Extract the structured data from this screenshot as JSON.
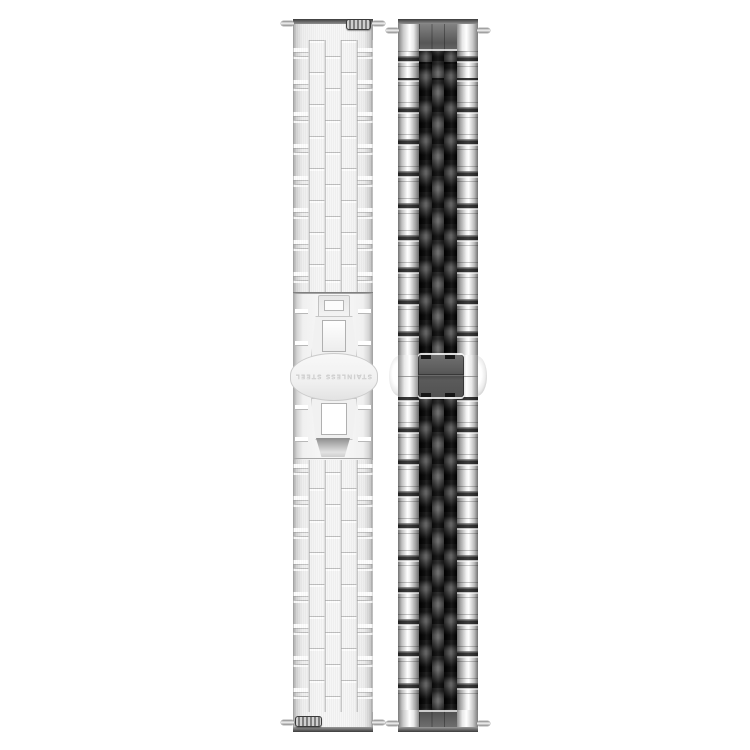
{
  "photo": {
    "background_color": "#ffffff",
    "clasp": {
      "engraving": "STAINLESS STEEL"
    },
    "left_band": {
      "label": "brushed silver link band, back side with folded butterfly clasp",
      "base_color": "#f2f2f2",
      "brick_line_color": "#bdbdbd",
      "edge_shade_color": "#9e9e9e",
      "spring_bar_color": "#3c3c3c"
    },
    "right_band": {
      "label": "five-link band front side, silver outer links with black center links",
      "outer_link_color": "#ffffff",
      "outer_link_shade": "#6b6b6b",
      "black_link_color": "#0c0c0c",
      "center_link_color": "#4e4e4e",
      "clasp_plate_color": "#5a5a5a"
    }
  }
}
